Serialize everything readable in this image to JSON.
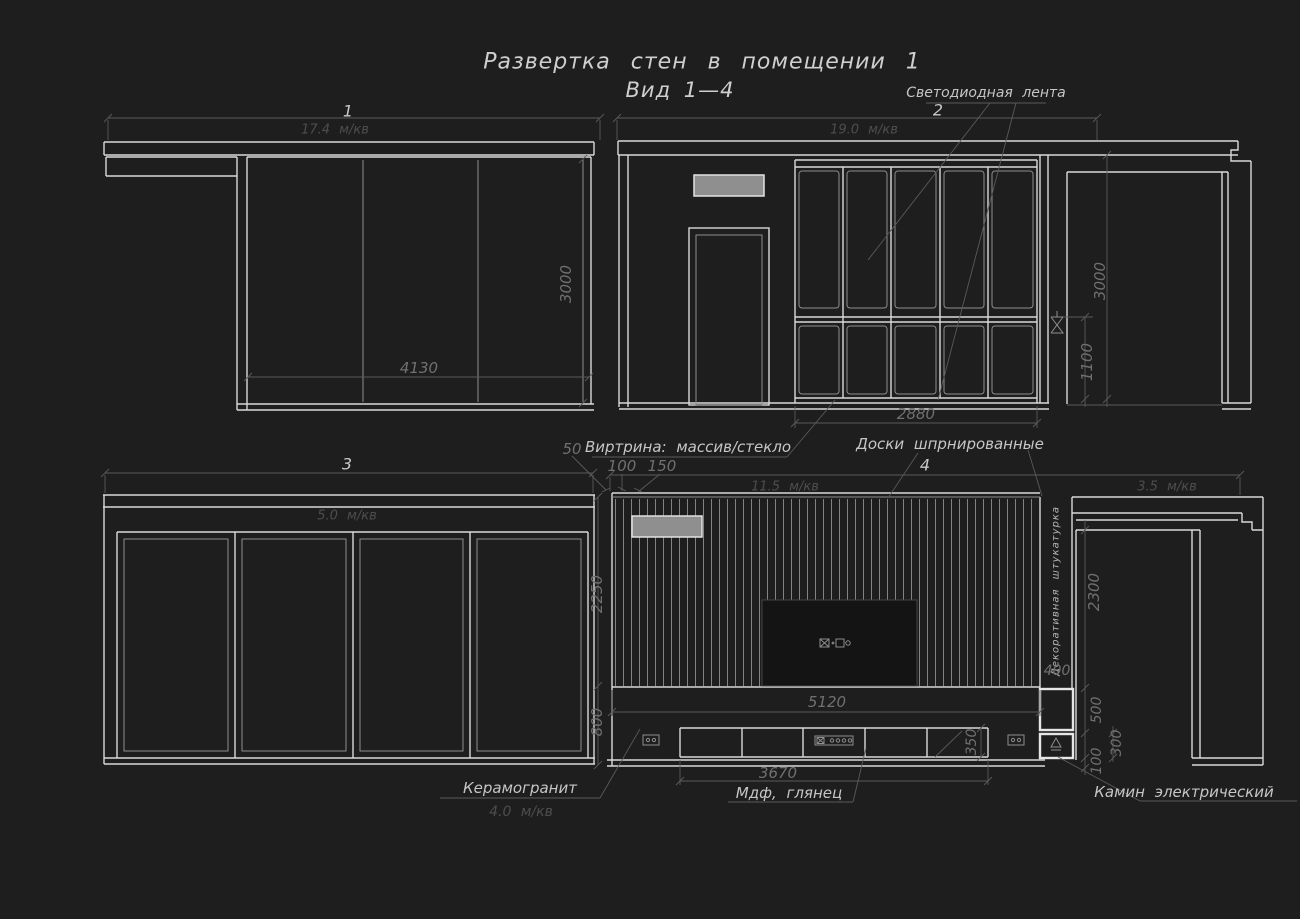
{
  "colors": {
    "background": "#1e1e1e",
    "line_bright": "#d9d9d9",
    "line_mid": "#8d8d8d",
    "line_dim": "#5a5a5a",
    "text_annotation": "#c6c6c6",
    "text_dimension": "#707070",
    "text_area": "#4d4d4d",
    "grille_fill": "#8f8f8f"
  },
  "title": {
    "line1": "Развертка стен в помещении 1",
    "line2": "Вид 1—4"
  },
  "view1": {
    "label": "1",
    "area": "17.4 м/кв",
    "dim_width": "4130",
    "dim_height": "3000"
  },
  "view2": {
    "label": "2",
    "area": "19.0 м/кв",
    "dim_height": "3000",
    "dim_led_height": "1100",
    "dim_cabinet_width": "2880",
    "led_annotation": "Светодиодная лента"
  },
  "view3": {
    "label": "3",
    "area": "5.0 м/кв"
  },
  "view4": {
    "label": "4",
    "area_left": "11.5 м/кв",
    "area_right": "3.5 м/кв",
    "dim_wall_height": "2250",
    "dim_console_zone": "800",
    "dim_wall_width": "5120",
    "dim_console_width": "3670",
    "dim_console_depth": "350",
    "dim_plaster": "400",
    "dim_opening_height": "2300",
    "dim_fireplace": "500",
    "dim_hearth": "300",
    "dim_plinth": "100",
    "plaster_annotation": "Декоративная штукатурка"
  },
  "layer_dims": {
    "a": "50",
    "b": "100",
    "c": "150"
  },
  "annotations": {
    "vitrine": "Виртрина: массив/стекло",
    "boards": "Доски шпрнированные",
    "ceramic": "Керамогранит",
    "ceramic_area": "4.0 м/кв",
    "mdf": "Мдф, глянец",
    "fireplace": "Камин электрический"
  }
}
